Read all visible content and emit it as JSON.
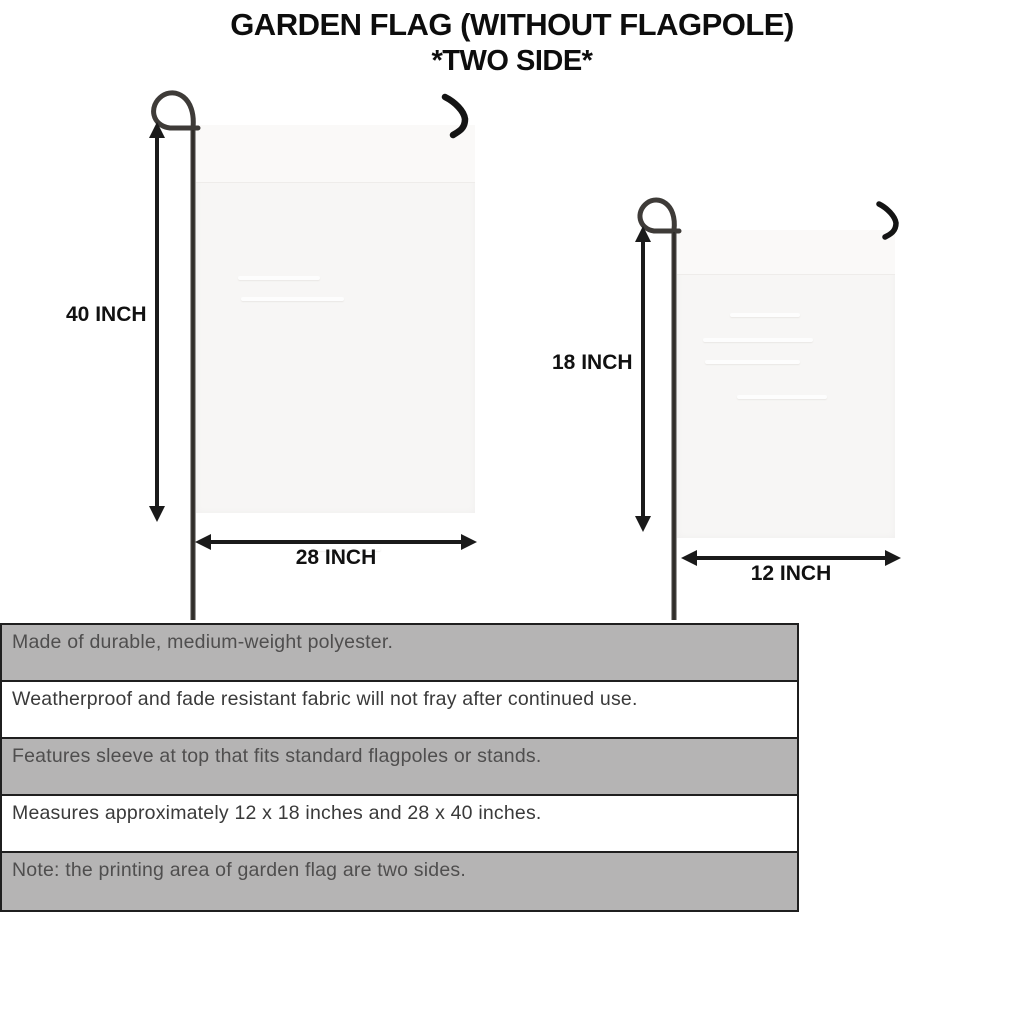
{
  "title": {
    "line1": "GARDEN FLAG (WITHOUT FLAGPOLE)",
    "line2": "*TWO SIDE*"
  },
  "flags": {
    "large": {
      "height_label": "40 INCH",
      "width_label": "28 INCH"
    },
    "small": {
      "height_label": "18 INCH",
      "width_label": "12 INCH"
    }
  },
  "features": [
    {
      "text": "Made of durable, medium-weight polyester.",
      "shaded": true
    },
    {
      "text": "Weatherproof and fade resistant fabric will not fray after continued use.",
      "shaded": false
    },
    {
      "text": "Features sleeve at top that fits standard flagpoles or stands.",
      "shaded": true
    },
    {
      "text": "Measures approximately 12 x 18 inches and 28 x 40 inches.",
      "shaded": false
    },
    {
      "text": "Note: the printing area of garden flag are two sides.",
      "shaded": true
    }
  ],
  "colors": {
    "title_text": "#0d0d0d",
    "arrow": "#1a1a1a",
    "pole": "#3e3b38",
    "flag_fill": "#f7f6f5",
    "row_shaded": "#b5b4b4",
    "row_plain": "#ffffff",
    "table_border": "#1f1f1f"
  }
}
